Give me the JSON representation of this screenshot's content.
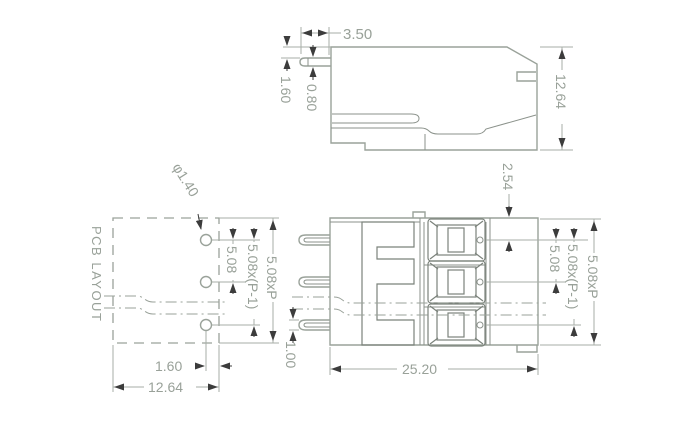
{
  "drawing": {
    "title": "PCB terminal block dimensional drawing",
    "palette": {
      "line_color": "#9aa29a",
      "detail_color": "#7b827b",
      "dimension_color": "#a7aea7",
      "text_color": "#99a199",
      "arrow_color": "#3c3c3c",
      "background": "#ffffff"
    },
    "side_view": {
      "pin_length": "3.50",
      "pin_top_offset": "1.60",
      "pin_thickness": "0.80",
      "body_height": "12.64"
    },
    "pcb_layout": {
      "title": "PCB LAYOUT",
      "hole_diameter": "φ1.40",
      "hole_pitch": "5.08",
      "hole_pitch_span": "5.08x(P-1)",
      "pattern_height": "5.08xP",
      "edge_offset": "1.60",
      "pattern_width": "12.64"
    },
    "top_view": {
      "first_pole_offset": "2.54",
      "pole_pitch": "5.08",
      "pole_pitch_span": "5.08x(P-1)",
      "body_span": "5.08xP",
      "body_width": "25.20",
      "pin_width": "1.00"
    }
  }
}
